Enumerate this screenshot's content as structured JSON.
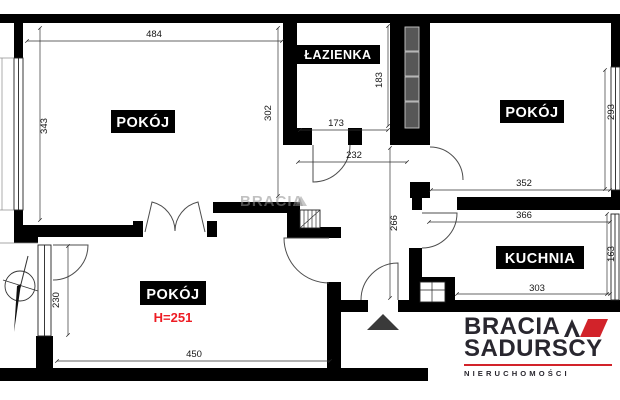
{
  "plan": {
    "rooms": {
      "top_left": {
        "label": "POKÓJ",
        "width": "484",
        "depth": "343",
        "inner_depth": "302"
      },
      "bathroom": {
        "label": "ŁAZIENKA",
        "width": "173",
        "depth": "183"
      },
      "top_right": {
        "label": "POKÓJ",
        "width": "352",
        "depth": "293"
      },
      "kitchen": {
        "label": "KUCHNIA",
        "top_width": "366",
        "bottom_width": "303",
        "depth": "163"
      },
      "bottom_left": {
        "label": "POKÓJ",
        "height_note": "H=251",
        "width": "450",
        "side": "230"
      }
    },
    "hall": {
      "width": "232",
      "depth": "266"
    },
    "watermark": "BRACIA",
    "colors": {
      "wall": "#000000",
      "label_bg": "#000000",
      "label_fg": "#ffffff",
      "height_note_red": "#ee1c24",
      "dim_text": "#161616"
    }
  },
  "logo": {
    "brand_top": "BRACIA",
    "brand_bottom": "SADURSCY",
    "tagline": "NIERUCHOMOŚCI",
    "accent_red": "#d2232a",
    "text_color": "#29272f"
  }
}
